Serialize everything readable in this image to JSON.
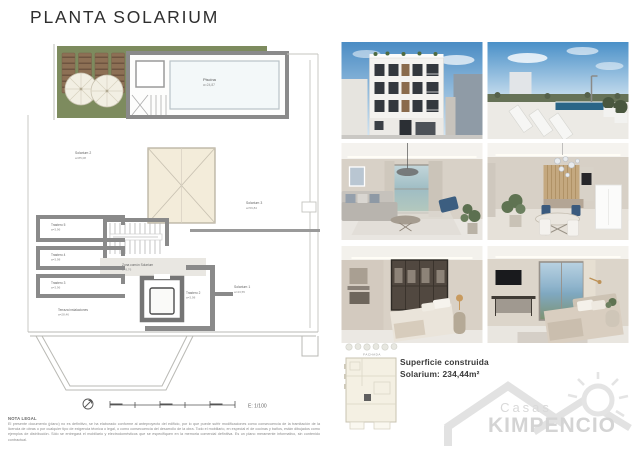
{
  "title": "PLANTA SOLARIUM",
  "plan": {
    "rooms": {
      "piscina": {
        "name": "Piscina",
        "area": "a=24,87"
      },
      "solarium2": {
        "name": "Solarium 2",
        "area": "a=85,08"
      },
      "solarium3": {
        "name": "Solarium 3",
        "area": "a=59,84"
      },
      "solarium1": {
        "name": "Solarium 1",
        "area": "a=43,55"
      },
      "trastero5": {
        "name": "Trastero 5",
        "area": "a=3,96"
      },
      "trastero4": {
        "name": "Trastero 4",
        "area": "a=3,98"
      },
      "trastero3": {
        "name": "Trastero 3",
        "area": "a=3,96"
      },
      "trastero2": {
        "name": "Trastero 2",
        "area": "a=3,98"
      },
      "zonacomun": {
        "name": "Zona común Solarium",
        "area": "a=9,76"
      },
      "terraza": {
        "name": "Terraza instalaciones",
        "area": "a=28,46"
      }
    },
    "scale_label": "E: 1/100"
  },
  "keyplan": {
    "caption": "FACHADA"
  },
  "summary": {
    "line1": "Superficie construida",
    "line2": "Solarium: 234,44m²"
  },
  "legal": {
    "heading": "NOTA LEGAL",
    "body": "El presente documento (plano) no es definitivo, se ha elaborado conforme al anteproyecto del edificio, por lo que puede sufrir modificaciones como consecuencia de la tramitación de la licencia de obras o por cualquier tipo de exigencia técnica o legal, o como consecuencia del desarrollo de la obra. Todo el mobiliario, en especial el de cocinas y baños, están dibujados como ejemplos de distribución. Sólo se entregará el mobiliario y electrodomésticos que se especifiquen en la memoria comercial definitiva. Es un plano meramente informativo, sin contenido contractual."
  },
  "logo": {
    "top": "Casas",
    "bottom": "KIMPENCIO"
  },
  "photos": {
    "facade": "render-fachada-edificio",
    "rooftop": "render-solarium-piscina",
    "living": "render-salon",
    "dining": "render-comedor",
    "bedroom1": "render-dormitorio-vestidor",
    "bedroom2": "render-dormitorio-vistas"
  },
  "colors": {
    "terrace_green": "#7d8b5e",
    "wall_gray": "#8a8a8a",
    "skylight_beige": "#f3ecda",
    "deck_brown": "#8d7055",
    "accent_blue": "#3c5e80",
    "logo_gray": "#dcdcdc"
  }
}
